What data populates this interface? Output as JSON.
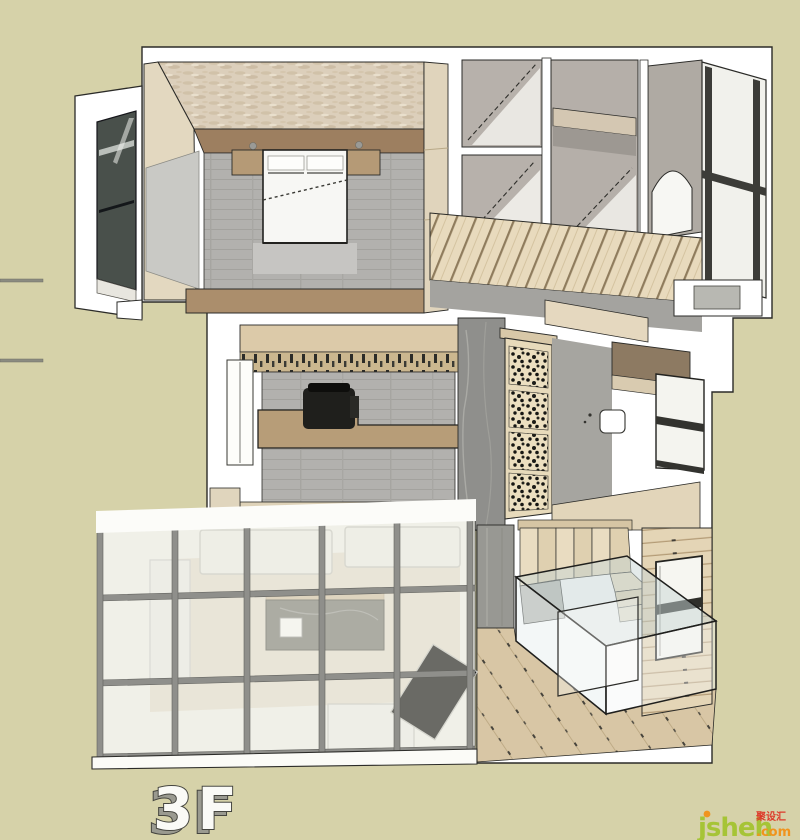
{
  "canvas": {
    "width": 800,
    "height": 840
  },
  "floor_plan": {
    "label": "3F",
    "view": "3d-top-down-dollhouse-render"
  },
  "watermark": {
    "brand": "jsheh",
    "cjk": "聚设汇",
    "suffix": ".com"
  },
  "palette": {
    "background": "#d6d2a9",
    "wall": "#ffffff",
    "outline": "#2b2b28",
    "floor_gray": "#b2b1ae",
    "wood_light": "#e6d9bd",
    "wood_mid": "#c8b590",
    "wood_dark": "#9d7f60",
    "travertine": "#dccfbb",
    "stone_gray": "#95948f",
    "glass_tint": "#dfe7e7",
    "logo_green": "#a6c436",
    "logo_orange": "#f0941d",
    "logo_red": "#dd3a2a"
  }
}
